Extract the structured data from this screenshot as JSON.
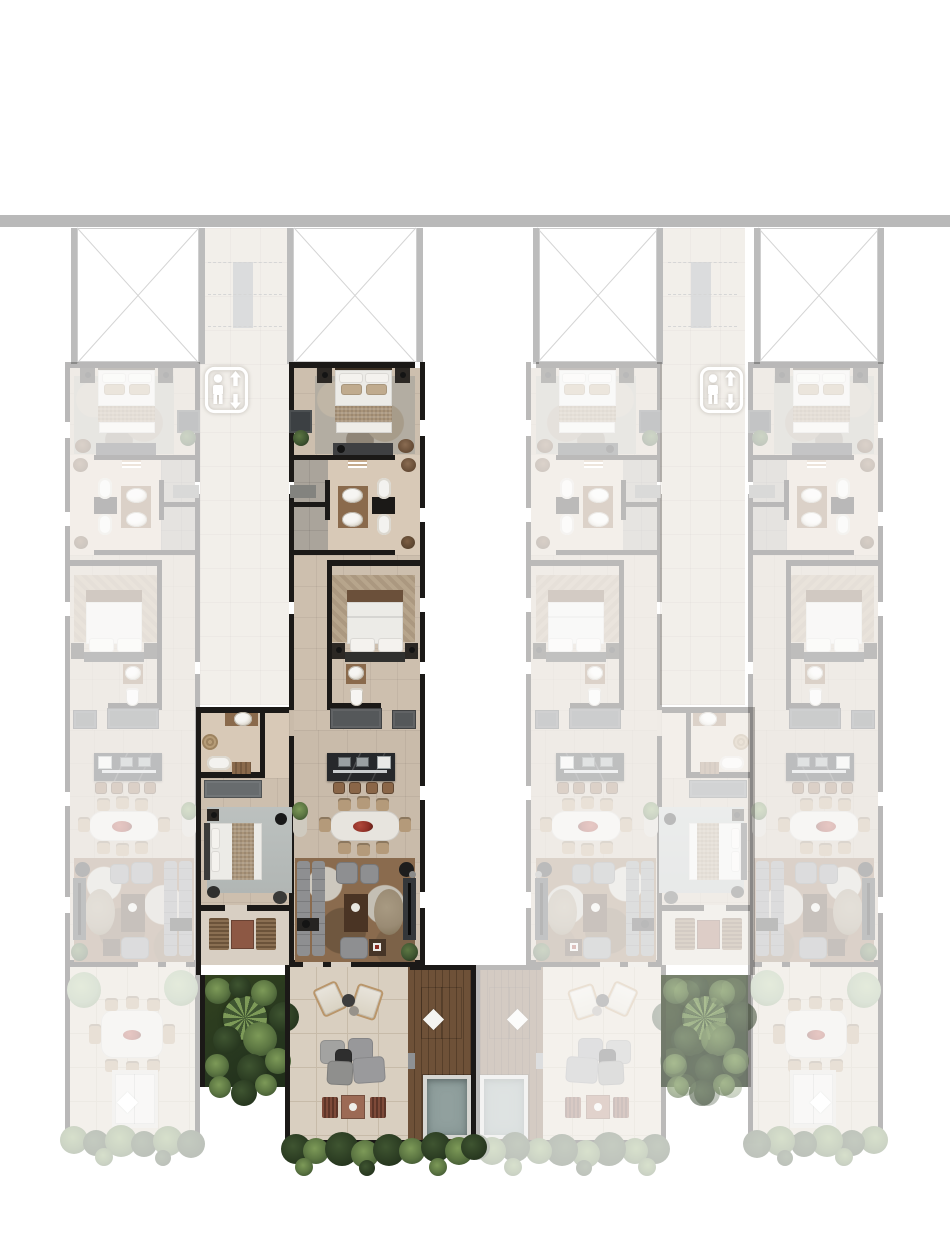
{
  "meta": {
    "kind": "architectural-floor-plan",
    "description": "Top-view rendered floor plate of a residential building; four apartment strips flank two elevator corridors. One L-shaped three-bedroom unit with private terrace, wood deck and plunge pool is shown highlighted in full color while neighboring units are faded.",
    "visible_text": ""
  },
  "render": {
    "faded_opacity": 0.3,
    "garden_overlay_opacity": 0.5
  },
  "colors": {
    "bar": "#b9b9b9",
    "ink": "#1b1917",
    "floor": "#cdbfae",
    "floor2": "#c9bbaa",
    "floorbath": "#d8c9b7",
    "floor3": "#d8cfc3",
    "tilegray": "#aaa49b",
    "terrace": "#d9cfc0",
    "terraceline": "#c7bba9",
    "wood": "#8a6a4c",
    "wooddark": "#4a3424",
    "deck": "#6e5138",
    "deckline": "#573f2a",
    "mattress": "#ecebe7",
    "ruggray": "#b3ada2",
    "rugbrown": "#8a6b4e",
    "sofagray": "#8e8f91",
    "graymid": "#55585a",
    "graydark": "#3c4043",
    "counter": "#26282b",
    "chairtan": "#b49a7a",
    "slatchair": "#8a6f52",
    "wicker": "#7e4a39",
    "pouftaupe": "#9a8b74",
    "red": "#8e2f26",
    "green1": "#27371f",
    "green2": "#3f5531",
    "green3": "#5d7743",
    "green4": "#7d9a58",
    "greenlight": "#8fa77f",
    "pool": "#91a09e",
    "corridor": "#e9e2d9",
    "stair": "#b3b9bb"
  },
  "structure": {
    "canvas": {
      "w": 950,
      "h": 1241
    },
    "top_bar": {
      "x": 0,
      "y": 215,
      "w": 950,
      "h": 12
    },
    "corridors": [
      {
        "x": 200,
        "y": 228,
        "w": 90,
        "h": 477
      },
      {
        "x": 660,
        "y": 228,
        "w": 85,
        "h": 477
      }
    ],
    "voids": [
      {
        "x": 77,
        "y": 228,
        "w": 122,
        "h": 134
      },
      {
        "x": 293,
        "y": 228,
        "w": 124,
        "h": 134
      },
      {
        "x": 539,
        "y": 228,
        "w": 118,
        "h": 134
      },
      {
        "x": 760,
        "y": 228,
        "w": 118,
        "h": 134
      }
    ],
    "elevators": [
      {
        "x": 204,
        "y": 366
      },
      {
        "x": 699,
        "y": 366
      }
    ],
    "garden_overlays": [
      {
        "x": 661,
        "y": 975,
        "w": 87,
        "h": 112
      }
    ]
  },
  "units": [
    {
      "id": "unit-left-2bed",
      "template": "b",
      "x": 65,
      "y": 362,
      "strip_w": 135,
      "mirrored": false,
      "faded": true,
      "highlighted": false,
      "rooms": [
        "bedroom",
        "bathroom",
        "bedroom",
        "ensuite",
        "kitchen",
        "dining",
        "living",
        "terrace-dining",
        "daybed",
        "garden-edge"
      ]
    },
    {
      "id": "unit-right-2bed",
      "template": "b",
      "x": 748,
      "y": 362,
      "strip_w": 135,
      "mirrored": true,
      "faded": true,
      "highlighted": false,
      "rooms": [
        "bedroom",
        "bathroom",
        "bedroom",
        "ensuite",
        "kitchen",
        "dining",
        "living",
        "terrace-dining",
        "daybed",
        "garden-edge"
      ]
    },
    {
      "id": "unit-mirror-3bed",
      "template": "a",
      "x": 526,
      "y": 362,
      "strip_w": 136,
      "mirrored": true,
      "faded": true,
      "highlighted": false,
      "rooms": [
        "master-bedroom",
        "double-bathroom",
        "bedroom-2",
        "ensuite",
        "kitchen",
        "dining",
        "living",
        "wing-bathroom",
        "wing-bedroom",
        "balcony",
        "garden",
        "terrace-lounge",
        "wood-deck",
        "plunge-pool"
      ]
    },
    {
      "id": "unit-highlighted-3bed",
      "template": "a",
      "x": 289,
      "y": 362,
      "strip_w": 136,
      "mirrored": false,
      "faded": false,
      "highlighted": true,
      "rooms": [
        "master-bedroom",
        "double-bathroom",
        "bedroom-2",
        "ensuite",
        "kitchen",
        "dining",
        "living",
        "wing-bathroom",
        "wing-bedroom",
        "balcony",
        "garden",
        "terrace-lounge",
        "wood-deck",
        "plunge-pool"
      ]
    }
  ],
  "icons": {
    "elevator": "person-with-up-down-arrows"
  }
}
